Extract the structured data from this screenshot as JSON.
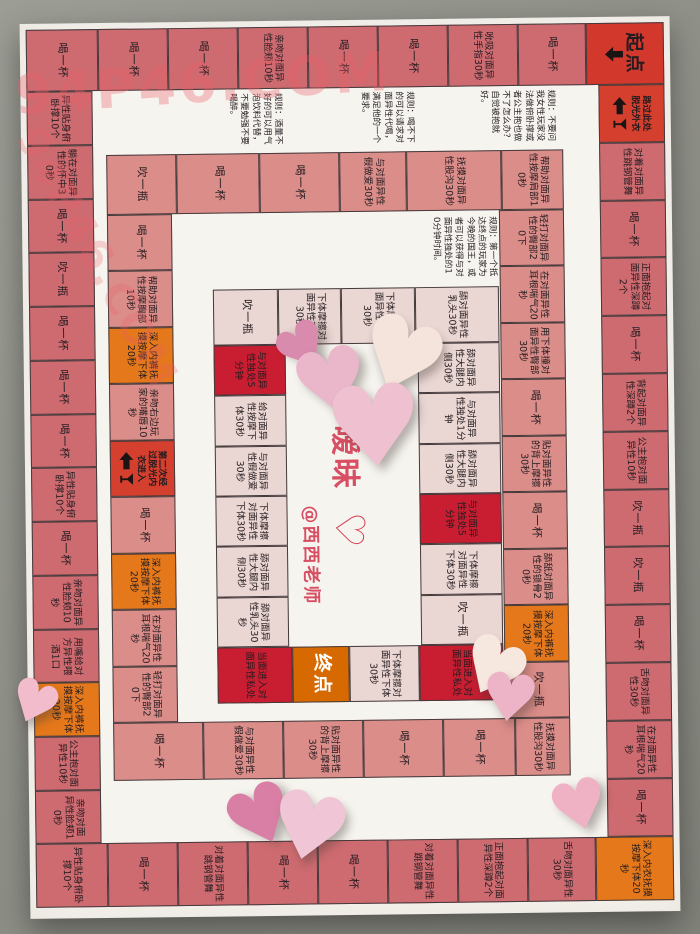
{
  "watermark": "94P46.COM",
  "center": {
    "title": "暧昧",
    "heart_symbol": "♡",
    "handle": "@西西老师"
  },
  "rules": {
    "rule_right": "规则：不要问我女性玩家没法做俯卧撑或者公主抱也做不了怎么办？自觉被抱就好。",
    "rule_mid": "规则：喝不下的可以请求对面异性代喝，满足他的一个要求。",
    "rule_left": "规则：酒量不好的可以用气泡饮料代替，不要勉强不要喝醉。",
    "rule_center": "规则：第一个抵达终点的玩家为今晚的国王，或者可以获得与对面异性独处的10分钟时间。"
  },
  "colors": {
    "rose": "#ce6b70",
    "salmon": "#db8d89",
    "cream": "#ead6d2",
    "red": "#c91d31",
    "orange": "#e5781a",
    "start": "#d2382b",
    "gate": "#d5402e",
    "end": "#d66a00",
    "paper": "#f6f4ef",
    "floor": "#8f9088",
    "accent_red": "#d84f63"
  },
  "rings": {
    "outer": {
      "default_type": "rose",
      "top": [
        {
          "label": "喝一杯"
        },
        {
          "label": "喝一杯"
        },
        {
          "label": "喝一杯"
        },
        {
          "label": "亲吻对面异性脸颊10秒"
        },
        {
          "label": "喝一杯"
        },
        {
          "label": "喝一杯"
        },
        {
          "label": "吮吸对面异性手指30秒"
        },
        {
          "label": "喝一杯"
        },
        {
          "label": "起点",
          "type": "start"
        }
      ],
      "right": [
        {
          "label": "路过此处脱光外衣",
          "type": "gate"
        },
        {
          "label": "对着对面异性跳钢管舞"
        },
        {
          "label": "喝一杯"
        },
        {
          "label": "正面抱起对面异性深蹲2个"
        },
        {
          "label": "喝一杯"
        },
        {
          "label": "背起对面异性深蹲2个"
        },
        {
          "label": "公主抱对面异性10秒"
        },
        {
          "label": "吹一瓶"
        },
        {
          "label": "吹一瓶"
        },
        {
          "label": "喝一杯"
        },
        {
          "label": "舌吻对面异性30秒"
        },
        {
          "label": "在对面异性耳根喘气20秒"
        },
        {
          "label": "喝一杯"
        }
      ],
      "bottom": [
        {
          "label": "异性贴身俯卧撑10个"
        },
        {
          "label": "喝一杯"
        },
        {
          "label": "对着对面异性跳钢管舞"
        },
        {
          "label": "喝一杯"
        },
        {
          "label": "喝一杯"
        },
        {
          "label": "对着对面异性跳钢管舞"
        },
        {
          "label": "正面抱起对面异性深蹲2个"
        },
        {
          "label": "舌吻对面异性30秒"
        },
        {
          "label": "深入内衣抚摸按摩下体20秒",
          "type": "orange"
        }
      ],
      "left": [
        {
          "label": "异性贴身俯卧撑10个"
        },
        {
          "label": "躺在对面异性的怀中30秒"
        },
        {
          "label": "喝一杯"
        },
        {
          "label": "吹一瓶"
        },
        {
          "label": "喝一杯"
        },
        {
          "label": "喝一杯"
        },
        {
          "label": "喝一杯"
        },
        {
          "label": "异性贴身俯卧撑10个"
        },
        {
          "label": "喝一杯"
        },
        {
          "label": "亲吻对面异性脸颊10秒"
        },
        {
          "label": "用嘴给对方异性喂酒1口"
        },
        {
          "label": "深入内裤抚摸按摩下体20秒",
          "type": "orange"
        },
        {
          "label": "公主抱对面异性10秒"
        },
        {
          "label": "亲吻对面异性脸颊10秒"
        }
      ]
    },
    "inner": {
      "default_type": "salmon",
      "top": [
        {
          "label": "吹一瓶"
        },
        {
          "label": "喝一杯"
        },
        {
          "label": "喝一杯"
        },
        {
          "label": "与对面异性假做爱30秒"
        },
        {
          "label": "抚摸对面异性股沟30秒"
        },
        {
          "label": "帮助对面异性按摩肩部10秒"
        }
      ],
      "right": [
        {
          "label": "轻打对面异性的臀部20下"
        },
        {
          "label": "在对面异性耳根喘气20秒"
        },
        {
          "label": "用下体撞对面异性臀部30秒"
        },
        {
          "label": "喝一杯"
        },
        {
          "label": "贴对面异性的背上摩擦30秒"
        },
        {
          "label": "喝一杯"
        },
        {
          "label": "舔舐对面异性的锁骨20秒"
        },
        {
          "label": "深入内裤抚摸按摩下体20秒",
          "type": "orange"
        },
        {
          "label": "吹一瓶"
        }
      ],
      "bottom": [
        {
          "label": "喝一杯"
        },
        {
          "label": "与对面异性假做爱30秒"
        },
        {
          "label": "贴对面异性的背上摩擦30秒"
        },
        {
          "label": "喝一杯"
        },
        {
          "label": "喝一杯"
        },
        {
          "label": "抚摸对面异性股沟30秒"
        }
      ],
      "left": [
        {
          "label": "喝一杯"
        },
        {
          "label": "帮助对面异性按摩胸部10秒"
        },
        {
          "label": "深入内裤抚摸按摩下体20秒",
          "type": "orange"
        },
        {
          "label": "亲吻右边玩家的嘴唇10秒"
        },
        {
          "label": "第二次经过脱光内衣进入",
          "type": "gate"
        },
        {
          "label": "喝一杯"
        },
        {
          "label": "深入内裤抚摸按摩下体20秒",
          "type": "orange"
        },
        {
          "label": "在对面异性耳根喘气20秒"
        },
        {
          "label": "轻打对面异性的臀部20下"
        }
      ]
    },
    "innermost": {
      "default_type": "cream",
      "top": [
        {
          "label": "吹一瓶"
        },
        {
          "label": "下体摩擦对面异性下体30秒"
        },
        {
          "label": "下体摩擦对面异性下体30秒"
        },
        {
          "label": "舔对面异性乳头30秒"
        }
      ],
      "right": [
        {
          "label": "舔对面异性大腿内侧30秒"
        },
        {
          "label": "与对面异性独处1分钟"
        },
        {
          "label": "舔对面异性大腿内侧30秒"
        },
        {
          "label": "与对面异性独处5分钟",
          "type": "red"
        },
        {
          "label": "下体摩擦对面异性下体30秒"
        },
        {
          "label": "吹一瓶"
        }
      ],
      "bottom": [
        {
          "label": "当面进入对面异性私处",
          "type": "red"
        },
        {
          "label": "终点",
          "type": "end"
        },
        {
          "label": "下体摩擦对面异性下体30秒"
        },
        {
          "label": "当面进入对面异性私处",
          "type": "red"
        }
      ],
      "left": [
        {
          "label": "与对面异性独处5分钟",
          "type": "red"
        },
        {
          "label": "给对面异性按摩下体30秒"
        },
        {
          "label": "与对面异性假做爱30秒"
        },
        {
          "label": "下体摩擦对面异性下体30秒"
        },
        {
          "label": "舔对面异性大腿内侧30秒"
        },
        {
          "label": "舔对面异性乳头30秒"
        }
      ]
    }
  },
  "hearts": [
    {
      "x": 252,
      "y": 296,
      "size": 62,
      "color": "#d98bad",
      "rot": -32
    },
    {
      "x": 268,
      "y": 318,
      "size": 88,
      "color": "#eab6ca",
      "rot": -12
    },
    {
      "x": 332,
      "y": 288,
      "size": 100,
      "color": "#f4e4dc",
      "rot": 22
    },
    {
      "x": 300,
      "y": 352,
      "size": 112,
      "color": "#efc0d0",
      "rot": -4
    },
    {
      "x": 430,
      "y": 612,
      "size": 78,
      "color": "#f6e7df",
      "rot": 28
    },
    {
      "x": 452,
      "y": 648,
      "size": 66,
      "color": "#edb3c6",
      "rot": 8
    },
    {
      "x": 196,
      "y": 756,
      "size": 80,
      "color": "#d97fa5",
      "rot": -24
    },
    {
      "x": 238,
      "y": 762,
      "size": 92,
      "color": "#f0c6d6",
      "rot": 14
    },
    {
      "x": 520,
      "y": 756,
      "size": 68,
      "color": "#efb2c5",
      "rot": -14
    },
    {
      "x": -20,
      "y": 650,
      "size": 58,
      "color": "#f2bccd",
      "rot": 24
    }
  ]
}
